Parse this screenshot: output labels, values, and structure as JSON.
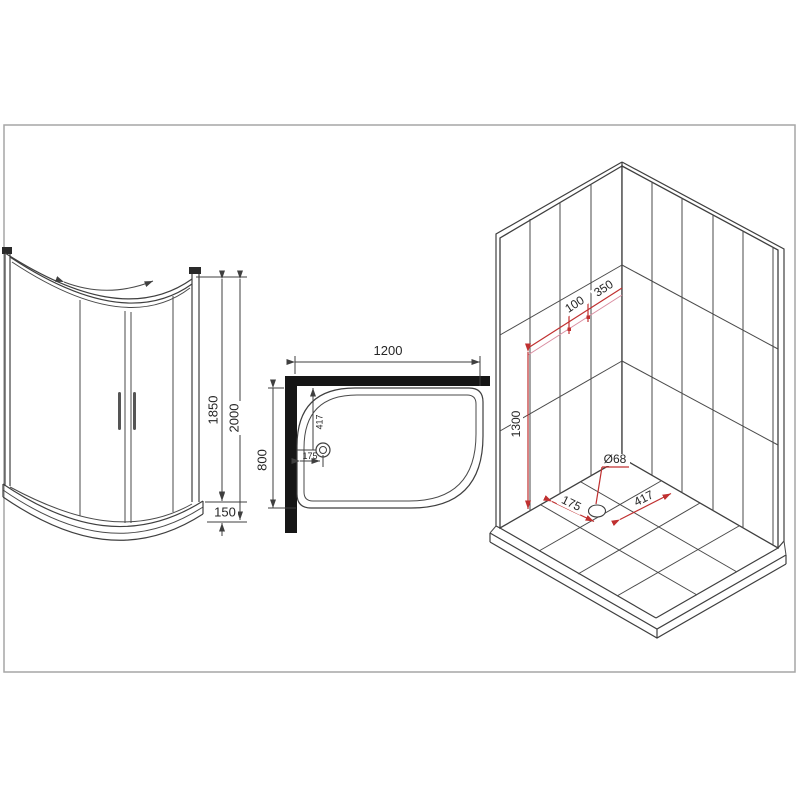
{
  "drawing": {
    "title": "quadrant-shower-enclosure-technical-drawing",
    "border_color": "#a6a6a6",
    "colors": {
      "line": "#3f3f3f",
      "wall_fill": "#161616",
      "dimension_red": "#c03030",
      "guide_pink": "#d98ca0",
      "background": "#ffffff",
      "text": "#262626"
    },
    "front_view": {
      "description": "front elevation of sliding-door quadrant enclosure",
      "dims": {
        "glass_height": "1850",
        "total_height": "2000",
        "tray_height": "150"
      }
    },
    "top_view": {
      "description": "plan view of offset quadrant tray with corner walls",
      "dims": {
        "width": "1200",
        "depth": "800",
        "drain_from_wall_y": "417",
        "drain_from_wall_x": "175"
      }
    },
    "iso_view": {
      "description": "isometric tiled corner with drain position",
      "dims": {
        "offset_100": "100",
        "offset_350": "350",
        "wall_height": "1300",
        "drain_diameter": "Ø68",
        "drain_offset_x": "175",
        "drain_offset_y": "417"
      }
    }
  }
}
